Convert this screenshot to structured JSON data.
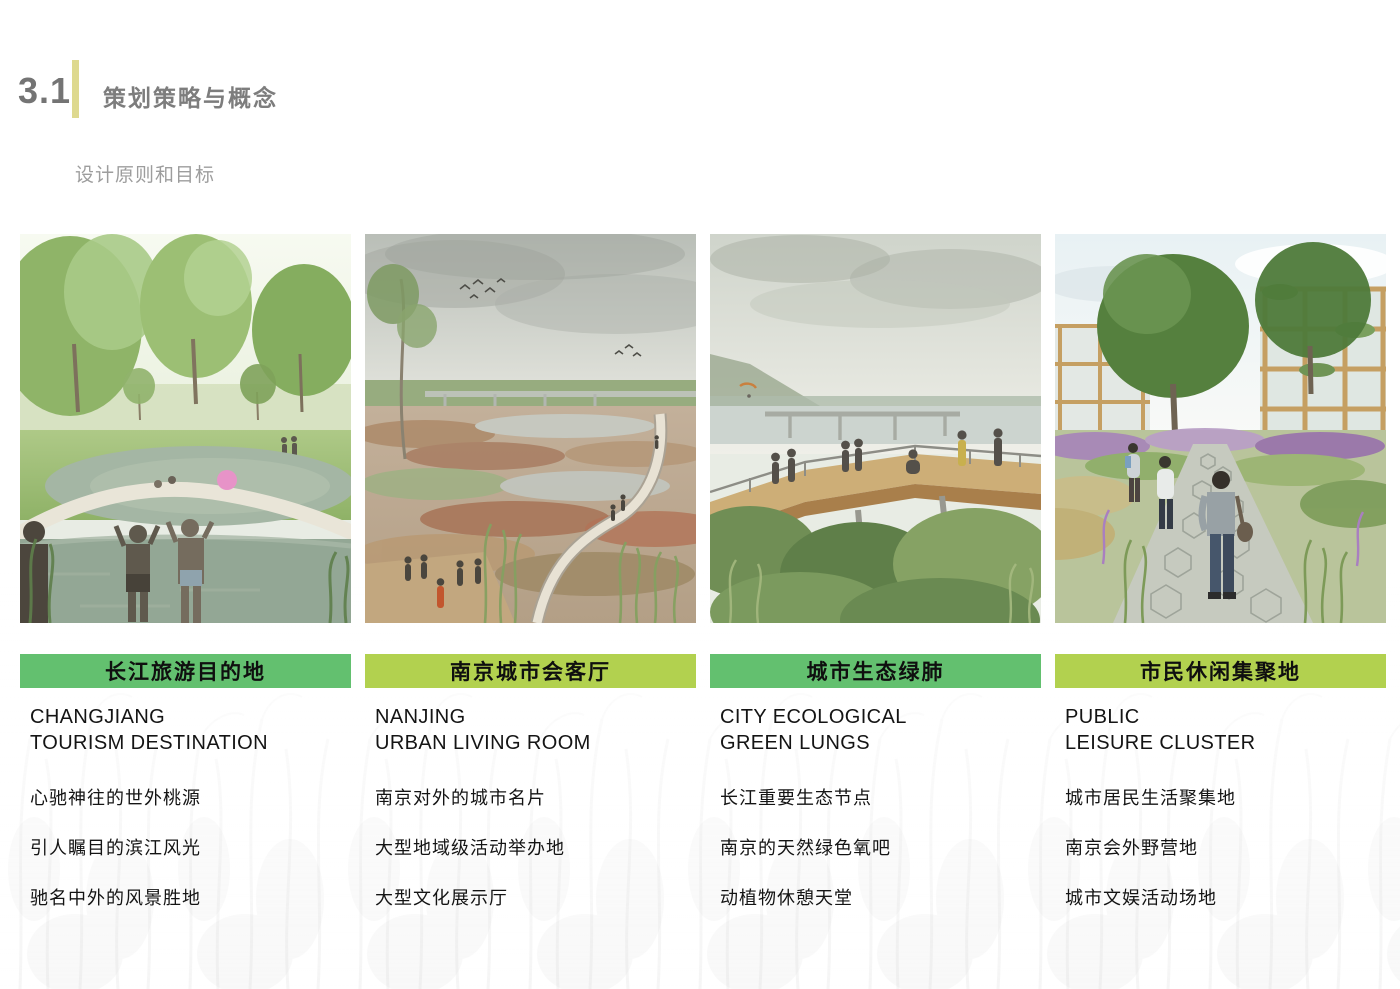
{
  "header": {
    "section_number": "3.1",
    "title": "策划策略与概念",
    "subtitle": "设计原则和目标"
  },
  "colors": {
    "accent_bar": "#ded98f",
    "banner_green": "#63c06f",
    "banner_lime": "#b2d14f"
  },
  "columns": [
    {
      "banner": "长江旅游目的地",
      "title": "CHANGJIANG\nTOURISM DESTINATION",
      "bullets": [
        "心驰神往的世外桃源",
        "引人瞩目的滨江风光",
        "驰名中外的风景胜地"
      ],
      "scene": "sunny park pond with children playing in water"
    },
    {
      "banner": "南京城市会客厅",
      "title": "NANJING\nURBAN LIVING ROOM",
      "bullets": [
        "南京对外的城市名片",
        "大型地域级活动举办地",
        "大型文化展示厅"
      ],
      "scene": "wetland marsh with winding boardwalk and visitors"
    },
    {
      "banner": "城市生态绿肺",
      "title": "CITY ECOLOGICAL\nGREEN LUNGS",
      "bullets": [
        "长江重要生态节点",
        "南京的天然绿色氧吧",
        "动植物休憩天堂"
      ],
      "scene": "elevated timber overlook above forest facing river bridge"
    },
    {
      "banner": "市民休闲集聚地",
      "title": "PUBLIC\nLEISURE CLUSTER",
      "bullets": [
        "城市居民生活聚集地",
        "南京会外野营地",
        "城市文娱活动场地"
      ],
      "scene": "hexagonal paver garden path with pedestrians and timber buildings"
    }
  ]
}
